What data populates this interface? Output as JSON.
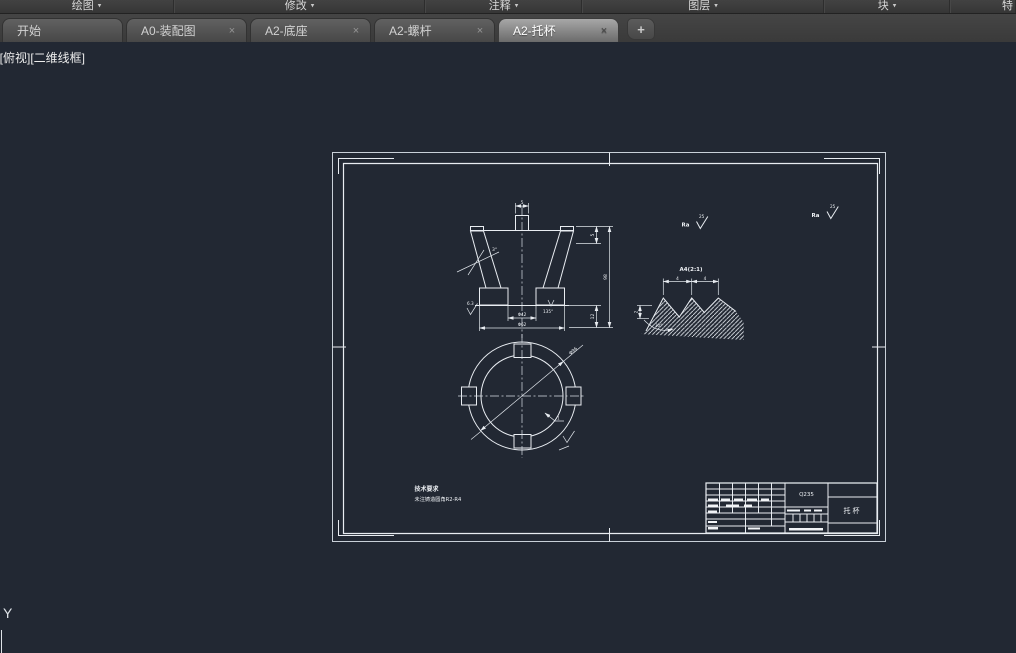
{
  "ribbon": {
    "caret": "▾",
    "panels": [
      {
        "label": "绘图"
      },
      {
        "label": "修改"
      },
      {
        "label": "注释"
      },
      {
        "label": "图层"
      },
      {
        "label": "块"
      },
      {
        "label": "特"
      }
    ]
  },
  "tabs": {
    "close_glyph": "×",
    "new_tab_glyph": "+",
    "items": [
      {
        "label": "开始"
      },
      {
        "label": "A0-装配图"
      },
      {
        "label": "A2-底座"
      },
      {
        "label": "A2-螺杆"
      },
      {
        "label": "A2-托杯"
      }
    ],
    "active_tab": "A2-托杯"
  },
  "viewport": {
    "controls": "[-][俯视][二维线框]"
  },
  "ucs": {
    "axis_label": "Y"
  },
  "colors": {
    "canvas_bg": "#222833",
    "line": "#e9edf2",
    "ribbon_bg": "#3a3a3a",
    "tabbar_bg": "#3d3d3d",
    "active_tab": "#a7a7a7"
  },
  "drawing": {
    "notes": {
      "title": "技术要求",
      "line": "未注铸造圆角R2-R4"
    },
    "title_block": {
      "material": "Q235",
      "part_name": "托杯"
    },
    "roughness_mid": {
      "prefix": "Ra",
      "value": "25"
    },
    "roughness_corner": {
      "prefix": "Ra",
      "value": "25"
    },
    "section": {
      "dim_boss": "5",
      "dim_step": "5",
      "dim_height": "98",
      "dim_flange": "12",
      "dim_inner_dia": "Φ42",
      "dim_outer_dia": "Φ62",
      "dim_taper": "3°",
      "note_chamfer": "135°",
      "roughness_bottom": "6.3"
    },
    "plan": {
      "dim_diameter": "Φ96",
      "leader_label": "1"
    },
    "detail": {
      "label": "A4(2:1)",
      "dim_pitch_left": "4",
      "dim_pitch_right": "4",
      "dim_depth": "2",
      "dim_angle": "30°"
    }
  }
}
